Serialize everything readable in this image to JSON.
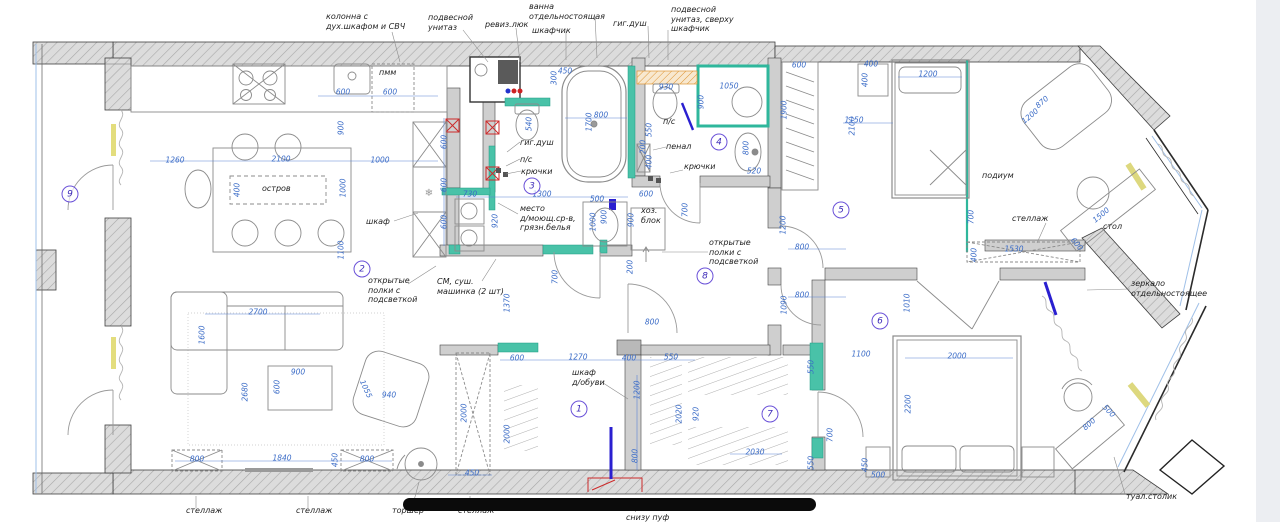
{
  "drawing": {
    "type": "apartment floor plan with furniture and dimensions (mm)"
  },
  "colors": {
    "dimension_text": "#3b6cc7",
    "label_text": "#1f1f1f",
    "room_number": "#3d2bb8",
    "teal_highlight": "#2fb79c",
    "yellow_highlight": "#e3dd7d",
    "orange_highlight": "#dd9433",
    "red_marker": "#cc2a2a",
    "blue_marker": "#2a1fd0",
    "wall_fill": "#dcdcdc"
  },
  "room_numbers": [
    {
      "n": "1",
      "x": 579,
      "y": 409
    },
    {
      "n": "2",
      "x": 362,
      "y": 269
    },
    {
      "n": "3",
      "x": 532,
      "y": 186
    },
    {
      "n": "4",
      "x": 719,
      "y": 142
    },
    {
      "n": "5",
      "x": 841,
      "y": 210
    },
    {
      "n": "6",
      "x": 880,
      "y": 321
    },
    {
      "n": "7",
      "x": 770,
      "y": 414
    },
    {
      "n": "8",
      "x": 705,
      "y": 276
    },
    {
      "n": "9",
      "x": 70,
      "y": 194
    }
  ],
  "labels": [
    {
      "t": "колонна с\nдух.шкафом и СВЧ",
      "x": 326,
      "y": 12
    },
    {
      "t": "подвесной\nунитаз",
      "x": 428,
      "y": 13
    },
    {
      "t": "ревиз.люк",
      "x": 485,
      "y": 20
    },
    {
      "t": "ванна\nотдельностоящая",
      "x": 529,
      "y": 2
    },
    {
      "t": "шкафчик",
      "x": 532,
      "y": 26
    },
    {
      "t": "гиг.душ",
      "x": 613,
      "y": 19
    },
    {
      "t": "подвесной\nунитаз, сверху\nшкафчик",
      "x": 671,
      "y": 5
    },
    {
      "t": "пмм",
      "x": 379,
      "y": 68
    },
    {
      "t": "остров",
      "x": 262,
      "y": 184
    },
    {
      "t": "шкаф",
      "x": 366,
      "y": 217
    },
    {
      "t": "открытые\nполки с\nподсветкой",
      "x": 368,
      "y": 276
    },
    {
      "t": "СМ, суш.\nмашинка (2 шт)",
      "x": 437,
      "y": 277
    },
    {
      "t": "гиг.душ",
      "x": 520,
      "y": 138
    },
    {
      "t": "п/с",
      "x": 520,
      "y": 155
    },
    {
      "t": "крючки",
      "x": 521,
      "y": 167
    },
    {
      "t": "место\nд/моющ.ср-в,\nгрязн.белья",
      "x": 520,
      "y": 204
    },
    {
      "t": "п/с",
      "x": 663,
      "y": 117
    },
    {
      "t": "пенал",
      "x": 666,
      "y": 142
    },
    {
      "t": "крючки",
      "x": 684,
      "y": 162
    },
    {
      "t": "хоз.\nблок",
      "x": 641,
      "y": 206
    },
    {
      "t": "открытые\nполки с\nподсветкой",
      "x": 709,
      "y": 238
    },
    {
      "t": "подиум",
      "x": 982,
      "y": 171
    },
    {
      "t": "стеллаж",
      "x": 1012,
      "y": 214
    },
    {
      "t": "стол",
      "x": 1103,
      "y": 222
    },
    {
      "t": "зеркало\nотдельностоящее",
      "x": 1131,
      "y": 279
    },
    {
      "t": "шкаф\nд/обуви",
      "x": 572,
      "y": 368
    },
    {
      "t": "туал.столик",
      "x": 1126,
      "y": 492
    },
    {
      "t": "стеллаж",
      "x": 186,
      "y": 506
    },
    {
      "t": "стеллаж",
      "x": 296,
      "y": 506
    },
    {
      "t": "торшер",
      "x": 392,
      "y": 506
    },
    {
      "t": "стеллаж",
      "x": 458,
      "y": 506
    },
    {
      "t": "зеркало, полки,\nснизу пуф",
      "x": 626,
      "y": 503
    }
  ],
  "dimensions": [
    {
      "t": "600",
      "x": 343,
      "y": 92
    },
    {
      "t": "600",
      "x": 390,
      "y": 92
    },
    {
      "t": "900",
      "x": 341,
      "y": 128,
      "r": -90
    },
    {
      "t": "1260",
      "x": 175,
      "y": 160
    },
    {
      "t": "2100",
      "x": 281,
      "y": 159
    },
    {
      "t": "1000",
      "x": 380,
      "y": 160
    },
    {
      "t": "400",
      "x": 237,
      "y": 190,
      "r": -90
    },
    {
      "t": "1000",
      "x": 343,
      "y": 188,
      "r": -90
    },
    {
      "t": "1100",
      "x": 341,
      "y": 250,
      "r": -90
    },
    {
      "t": "600",
      "x": 444,
      "y": 142,
      "r": -90
    },
    {
      "t": "600",
      "x": 444,
      "y": 185,
      "r": -90
    },
    {
      "t": "600",
      "x": 444,
      "y": 222,
      "r": -90
    },
    {
      "t": "2700",
      "x": 258,
      "y": 312
    },
    {
      "t": "1600",
      "x": 202,
      "y": 335,
      "r": -90
    },
    {
      "t": "2680",
      "x": 245,
      "y": 392,
      "r": -90
    },
    {
      "t": "900",
      "x": 298,
      "y": 372
    },
    {
      "t": "600",
      "x": 277,
      "y": 387,
      "r": -90
    },
    {
      "t": "1055",
      "x": 366,
      "y": 389,
      "r": 65
    },
    {
      "t": "940",
      "x": 389,
      "y": 395
    },
    {
      "t": "800",
      "x": 197,
      "y": 459
    },
    {
      "t": "1840",
      "x": 282,
      "y": 458
    },
    {
      "t": "450",
      "x": 335,
      "y": 460,
      "r": -90
    },
    {
      "t": "800",
      "x": 367,
      "y": 459
    },
    {
      "t": "540",
      "x": 529,
      "y": 124,
      "r": -90
    },
    {
      "t": "450",
      "x": 565,
      "y": 71
    },
    {
      "t": "300",
      "x": 554,
      "y": 78,
      "r": -90
    },
    {
      "t": "1700",
      "x": 589,
      "y": 122,
      "r": -90
    },
    {
      "t": "800",
      "x": 601,
      "y": 115
    },
    {
      "t": "730",
      "x": 470,
      "y": 194
    },
    {
      "t": "1300",
      "x": 542,
      "y": 194
    },
    {
      "t": "500",
      "x": 597,
      "y": 199
    },
    {
      "t": "920",
      "x": 495,
      "y": 221,
      "r": -90
    },
    {
      "t": "1000",
      "x": 593,
      "y": 222,
      "r": -90
    },
    {
      "t": "900",
      "x": 631,
      "y": 220,
      "r": -90
    },
    {
      "t": "930",
      "x": 666,
      "y": 87
    },
    {
      "t": "1050",
      "x": 729,
      "y": 86
    },
    {
      "t": "900",
      "x": 701,
      "y": 102,
      "r": -90
    },
    {
      "t": "550",
      "x": 649,
      "y": 130,
      "r": -90
    },
    {
      "t": "200",
      "x": 643,
      "y": 147,
      "r": -90
    },
    {
      "t": "400",
      "x": 649,
      "y": 162,
      "r": -90
    },
    {
      "t": "800",
      "x": 746,
      "y": 148,
      "r": -90
    },
    {
      "t": "520",
      "x": 754,
      "y": 171
    },
    {
      "t": "600",
      "x": 646,
      "y": 194
    },
    {
      "t": "900",
      "x": 604,
      "y": 217,
      "r": -90
    },
    {
      "t": "200",
      "x": 630,
      "y": 267,
      "r": -90
    },
    {
      "t": "700",
      "x": 685,
      "y": 210,
      "r": -90
    },
    {
      "t": "800",
      "x": 802,
      "y": 247
    },
    {
      "t": "800",
      "x": 802,
      "y": 295
    },
    {
      "t": "1090",
      "x": 784,
      "y": 305,
      "r": -90
    },
    {
      "t": "800",
      "x": 652,
      "y": 322
    },
    {
      "t": "1370",
      "x": 507,
      "y": 303,
      "r": -90
    },
    {
      "t": "700",
      "x": 555,
      "y": 277,
      "r": -90
    },
    {
      "t": "1200",
      "x": 783,
      "y": 225,
      "r": -90
    },
    {
      "t": "600",
      "x": 799,
      "y": 65
    },
    {
      "t": "400",
      "x": 871,
      "y": 64
    },
    {
      "t": "400",
      "x": 865,
      "y": 80,
      "r": -90
    },
    {
      "t": "1200",
      "x": 928,
      "y": 74
    },
    {
      "t": "1900",
      "x": 784,
      "y": 110,
      "r": -90
    },
    {
      "t": "1150",
      "x": 854,
      "y": 120
    },
    {
      "t": "2100",
      "x": 852,
      "y": 126,
      "r": -90
    },
    {
      "t": "870",
      "x": 1042,
      "y": 102,
      "r": -40
    },
    {
      "t": "1200",
      "x": 1030,
      "y": 116,
      "r": -40
    },
    {
      "t": "700",
      "x": 971,
      "y": 217,
      "r": -90
    },
    {
      "t": "1530",
      "x": 1014,
      "y": 249
    },
    {
      "t": "400",
      "x": 974,
      "y": 255,
      "r": -90
    },
    {
      "t": "1500",
      "x": 1101,
      "y": 215,
      "r": -40
    },
    {
      "t": "600",
      "x": 1077,
      "y": 244,
      "r": 50
    },
    {
      "t": "600",
      "x": 517,
      "y": 358
    },
    {
      "t": "1270",
      "x": 578,
      "y": 357
    },
    {
      "t": "400",
      "x": 629,
      "y": 358
    },
    {
      "t": "550",
      "x": 671,
      "y": 357
    },
    {
      "t": "2000",
      "x": 464,
      "y": 413,
      "r": -90
    },
    {
      "t": "2000",
      "x": 507,
      "y": 434,
      "r": -90
    },
    {
      "t": "1200",
      "x": 637,
      "y": 390,
      "r": -90
    },
    {
      "t": "800",
      "x": 635,
      "y": 456,
      "r": -90
    },
    {
      "t": "450",
      "x": 472,
      "y": 473
    },
    {
      "t": "2020",
      "x": 679,
      "y": 414,
      "r": -90
    },
    {
      "t": "920",
      "x": 696,
      "y": 414,
      "r": -90
    },
    {
      "t": "2030",
      "x": 755,
      "y": 452
    },
    {
      "t": "550",
      "x": 811,
      "y": 367,
      "r": -90
    },
    {
      "t": "550",
      "x": 811,
      "y": 463,
      "r": -90
    },
    {
      "t": "700",
      "x": 830,
      "y": 435,
      "r": -90
    },
    {
      "t": "1100",
      "x": 861,
      "y": 354
    },
    {
      "t": "450",
      "x": 865,
      "y": 465,
      "r": -90
    },
    {
      "t": "500",
      "x": 878,
      "y": 475
    },
    {
      "t": "1010",
      "x": 907,
      "y": 303,
      "r": -90
    },
    {
      "t": "2000",
      "x": 957,
      "y": 356
    },
    {
      "t": "2200",
      "x": 908,
      "y": 404,
      "r": -90
    },
    {
      "t": "800",
      "x": 1089,
      "y": 424,
      "r": -42
    },
    {
      "t": "500",
      "x": 1109,
      "y": 411,
      "r": 45
    }
  ]
}
